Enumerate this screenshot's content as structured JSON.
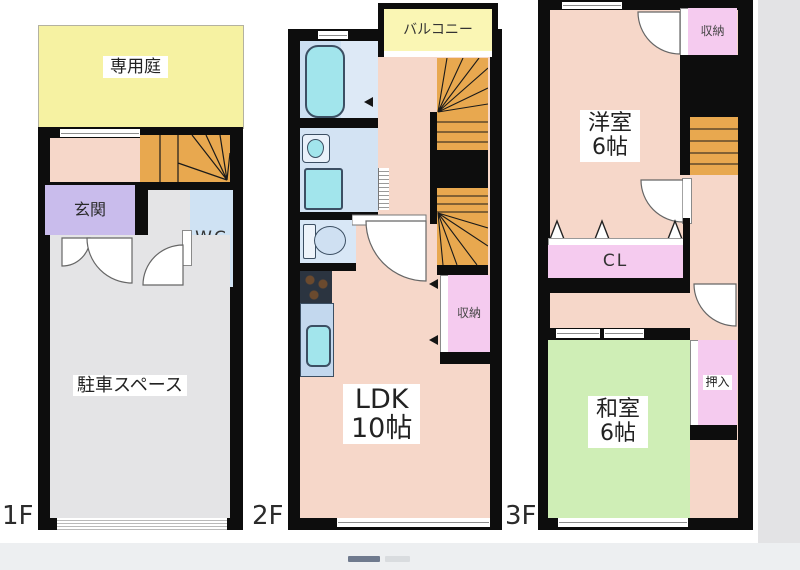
{
  "viewer": {
    "carousel": {
      "bars": [
        {
          "state": "active",
          "color": "#6f7a8e"
        },
        {
          "state": "inactive",
          "color": "#d9dcdf"
        }
      ],
      "background": "#edeff1"
    },
    "side_margin_color": "#e3e3e5"
  },
  "colors": {
    "wall": "#0d0d0d",
    "room_pink": "#f6d7c9",
    "storage_pink": "#f5cbef",
    "tatami_green": "#cfeeb6",
    "garden_yellow": "#f6f2a2",
    "balcony_yellow": "#faf6b4",
    "entrance_purple": "#c9bcec",
    "stairs_orange": "#e8a84f",
    "water_room_blue": "#cfe2f3",
    "fixture_cyan": "#a2e5ec",
    "parking_gray": "#e4e4e6"
  },
  "floors": {
    "f1": {
      "label": "1F",
      "garden": "専用庭",
      "entrance": "玄関",
      "wc": "WC",
      "parking": "駐車スペース"
    },
    "f2": {
      "label": "2F",
      "balcony": "バルコニー",
      "storage": "収納",
      "ldk_name": "LDK",
      "ldk_size": "10帖"
    },
    "f3": {
      "label": "3F",
      "storage": "収納",
      "western_room": "洋室",
      "western_size": "6帖",
      "closet": "CL",
      "japanese_room": "和室",
      "japanese_size": "6帖",
      "oshiire": "押入"
    }
  }
}
